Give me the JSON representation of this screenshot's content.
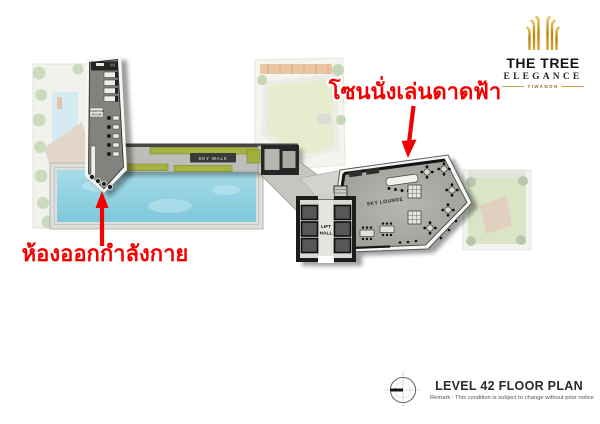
{
  "page": {
    "background": "#ffffff"
  },
  "logo": {
    "name": "THE TREE",
    "tagline": "ELEGANCE",
    "location": "TIWANON",
    "gold_color": "#c7a23a",
    "tree_icon": "golden-tree-icon"
  },
  "callouts": {
    "rooftop": {
      "text": "โซนนั่งเล่นดาดฟ้า",
      "color": "#f40000"
    },
    "gym": {
      "text": "ห้องออกกำลังกาย",
      "color": "#f40000"
    }
  },
  "plan_labels": {
    "sky_walk": "SKY WALK",
    "sky_lounge": "SKY LOUNGE",
    "lift_line1": "LIFT",
    "lift_line2": "HALL",
    "exercise_line1": "EXERCISE",
    "exercise_line2": "ROOM"
  },
  "title_block": {
    "title": "LEVEL 42 FLOOR PLAN",
    "remark": "Remark : This condition is subject to change without prior notice",
    "compass_icon": "north-compass-icon"
  }
}
